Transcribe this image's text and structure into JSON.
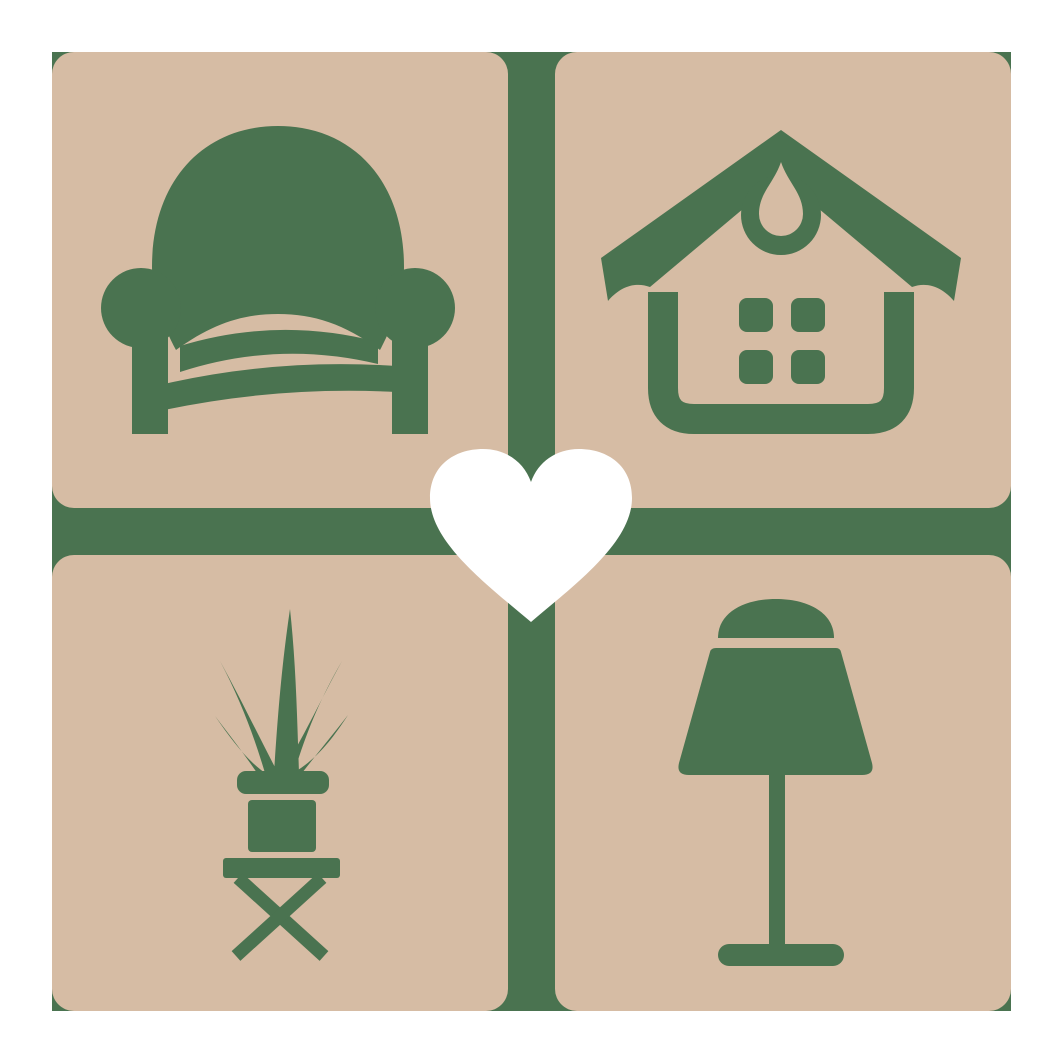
{
  "logo": {
    "description": "Home decor and furniture logo: four rounded beige tiles with green armchair, house, potted plant and table lamp icons, separated by a green cross divider, with a white heart in the center"
  },
  "colors": {
    "background": "#ffffff",
    "tile": "#d6bca4",
    "icon_green": "#4a7350",
    "divider_green": "#4a7350",
    "heart": "#ffffff"
  },
  "tiles": [
    {
      "id": "armchair",
      "icon": "armchair-icon",
      "position": "top-left"
    },
    {
      "id": "house",
      "icon": "house-icon",
      "position": "top-right"
    },
    {
      "id": "potted-plant",
      "icon": "potted-plant-icon",
      "position": "bottom-left"
    },
    {
      "id": "table-lamp",
      "icon": "table-lamp-icon",
      "position": "bottom-right"
    }
  ],
  "center": {
    "icon": "heart-icon"
  }
}
